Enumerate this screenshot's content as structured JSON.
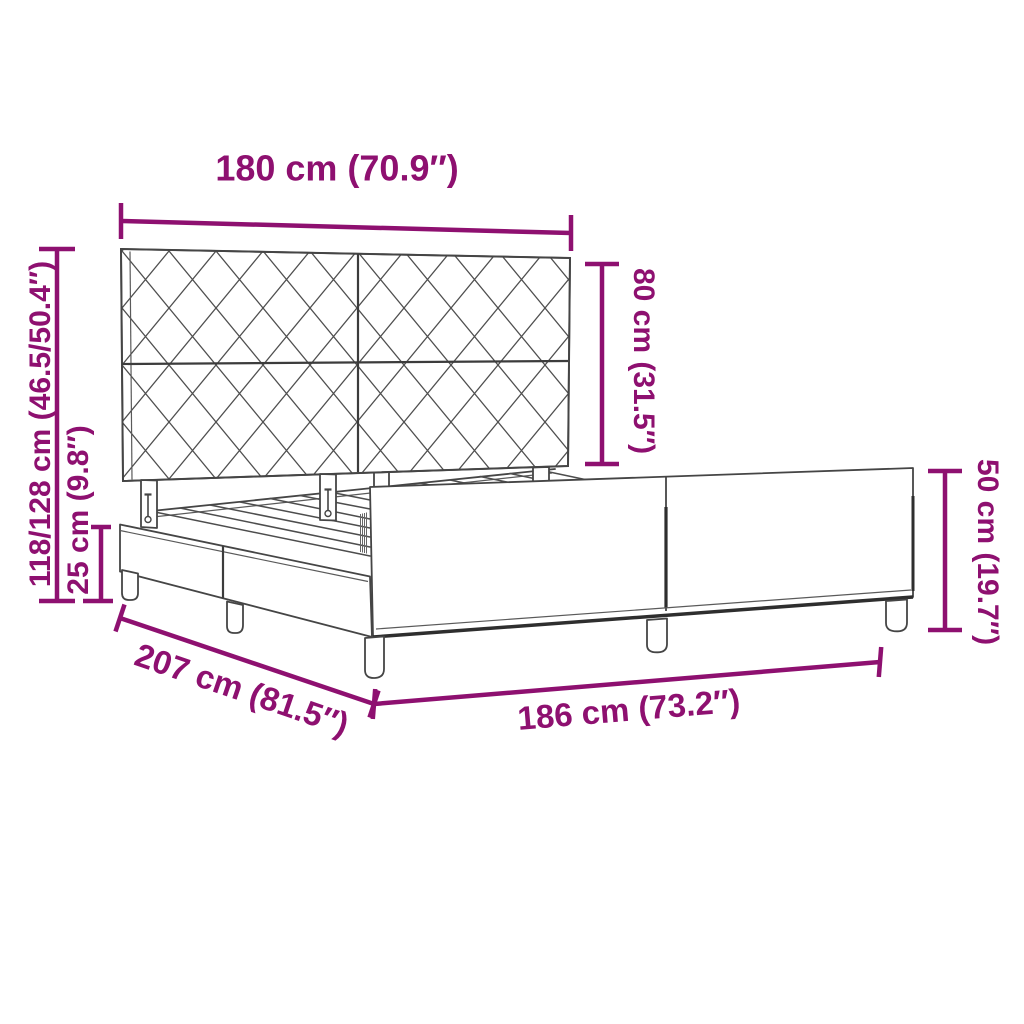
{
  "diagram": {
    "type": "product-dimension-diagram",
    "subject": "bed-frame-with-patterned-headboard",
    "accent_color": "#8E1070",
    "line_color": "#454545",
    "labels": {
      "headboard_width": "180 cm (70.9″)",
      "headboard_panel_height": "80 cm (31.5″)",
      "headboard_total_height": "118/128 cm (46.5/50.4″)",
      "frame_side_height": "25 cm (9.8″)",
      "foot_end_height": "50 cm (19.7″)",
      "frame_length": "207 cm (81.5″)",
      "frame_width": "186 cm (73.2″)"
    }
  }
}
